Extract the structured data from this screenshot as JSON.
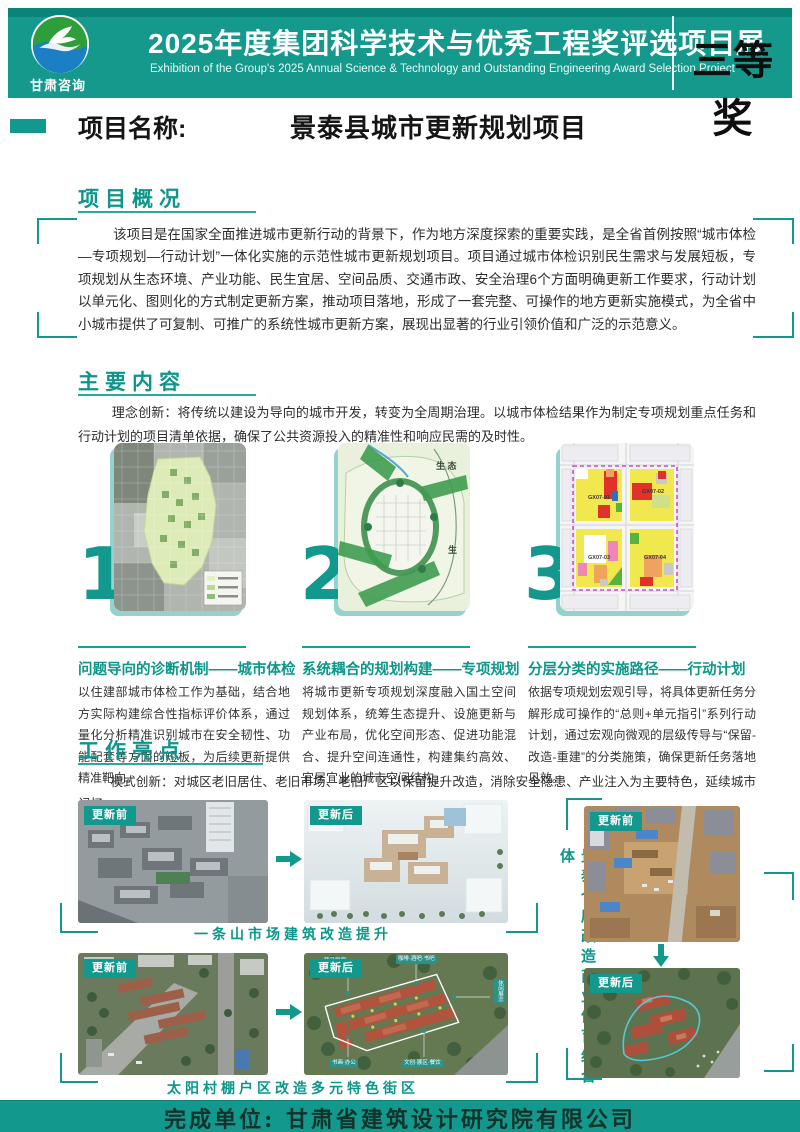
{
  "header": {
    "logo_caption": "甘肃咨询",
    "title": "2025年度集团科学技术与优秀工程奖评选项目展",
    "subtitle": "Exhibition of the Group's 2025 Annual Science & Technology and Outstanding Engineering Award Selection Project",
    "award_badge": "三等奖"
  },
  "project": {
    "label": "项目名称:",
    "name": "景泰县城市更新规划项目"
  },
  "sections": {
    "overview": {
      "heading": "项目概况",
      "body": "该项目是在国家全面推进城市更新行动的背景下，作为地方深度探索的重要实践，是全省首例按照“城市体检—专项规划—行动计划”一体化实施的示范性城市更新规划项目。项目通过城市体检识别民生需求与发展短板，专项规划从生态环境、产业功能、民生宜居、空间品质、交通市政、安全治理6个方面明确更新工作要求，行动计划以单元化、图则化的方式制定更新方案，推动项目落地，形成了一套完整、可操作的地方更新实施模式，为全省中小城市提供了可复制、可推广的系统性城市更新方案，展现出显著的行业引领价值和广泛的示范意义。"
    },
    "main_content": {
      "heading": "主要内容",
      "intro": "理念创新：将传统以建设为导向的城市开发，转变为全周期治理。以城市体检结果作为制定专项规划重点任务和行动计划的项目清单依据，确保了公共资源投入的精准性和响应民需的及时性。",
      "items": [
        {
          "number": "1",
          "title": "问题导向的诊断机制——城市体检",
          "body": "以住建部城市体检工作为基础，结合地方实际构建综合性指标评价体系，通过量化分析精准识别城市在安全韧性、功能配套等方面的短板，为后续更新提供精准靶向。"
        },
        {
          "number": "2",
          "title": "系统耦合的规划构建——专项规划",
          "body": "将城市更新专项规划深度融入国土空间规划体系，统筹生态提升、设施更新与产业布局，优化空间形态、促进功能混合、提升空间连通性，构建集约高效、宜居宜业的城市空间结构。"
        },
        {
          "number": "3",
          "title": "分层分类的实施路径——行动计划",
          "body": "依据专项规划宏观引导，将具体更新任务分解形成可操作的“总则+单元指引”系列行动计划，通过宏观向微观的层级传导与“保留-改造-重建”的分类施策，确保更新任务落地见效。"
        }
      ],
      "map_labels": {
        "eco_large": "生 态",
        "eco_small": "生",
        "blocks": [
          "GX07-01",
          "GX07-02",
          "GX07-03",
          "GX07-04"
        ]
      }
    },
    "highlights": {
      "heading": "工作亮点",
      "intro": "模式创新：对城区老旧居住、老旧市场、老旧厂区以保留提升改造，消除安全隐患、产业注入为主要特色，延续城市记忆。",
      "before_label": "更新前",
      "after_label": "更新后",
      "rows": [
        {
          "caption": "一条山市场建筑改造提升"
        },
        {
          "caption": "太阳村棚户区改造多元特色街区"
        }
      ],
      "side_caption": "景泰仓库改造商业体育综合体",
      "callout_tags": [
        "精品民宿",
        "咖啡·酒吧·书吧",
        "休闲展示",
        "书画·办公",
        "文创·展区·餐饮"
      ]
    }
  },
  "footer": {
    "completed_by": "完成单位: 甘肃省建筑设计研究院有限公司"
  },
  "colors": {
    "accent_teal": "#12988c",
    "header_dark": "#0b8478",
    "award_text": "#0e0e0e"
  }
}
